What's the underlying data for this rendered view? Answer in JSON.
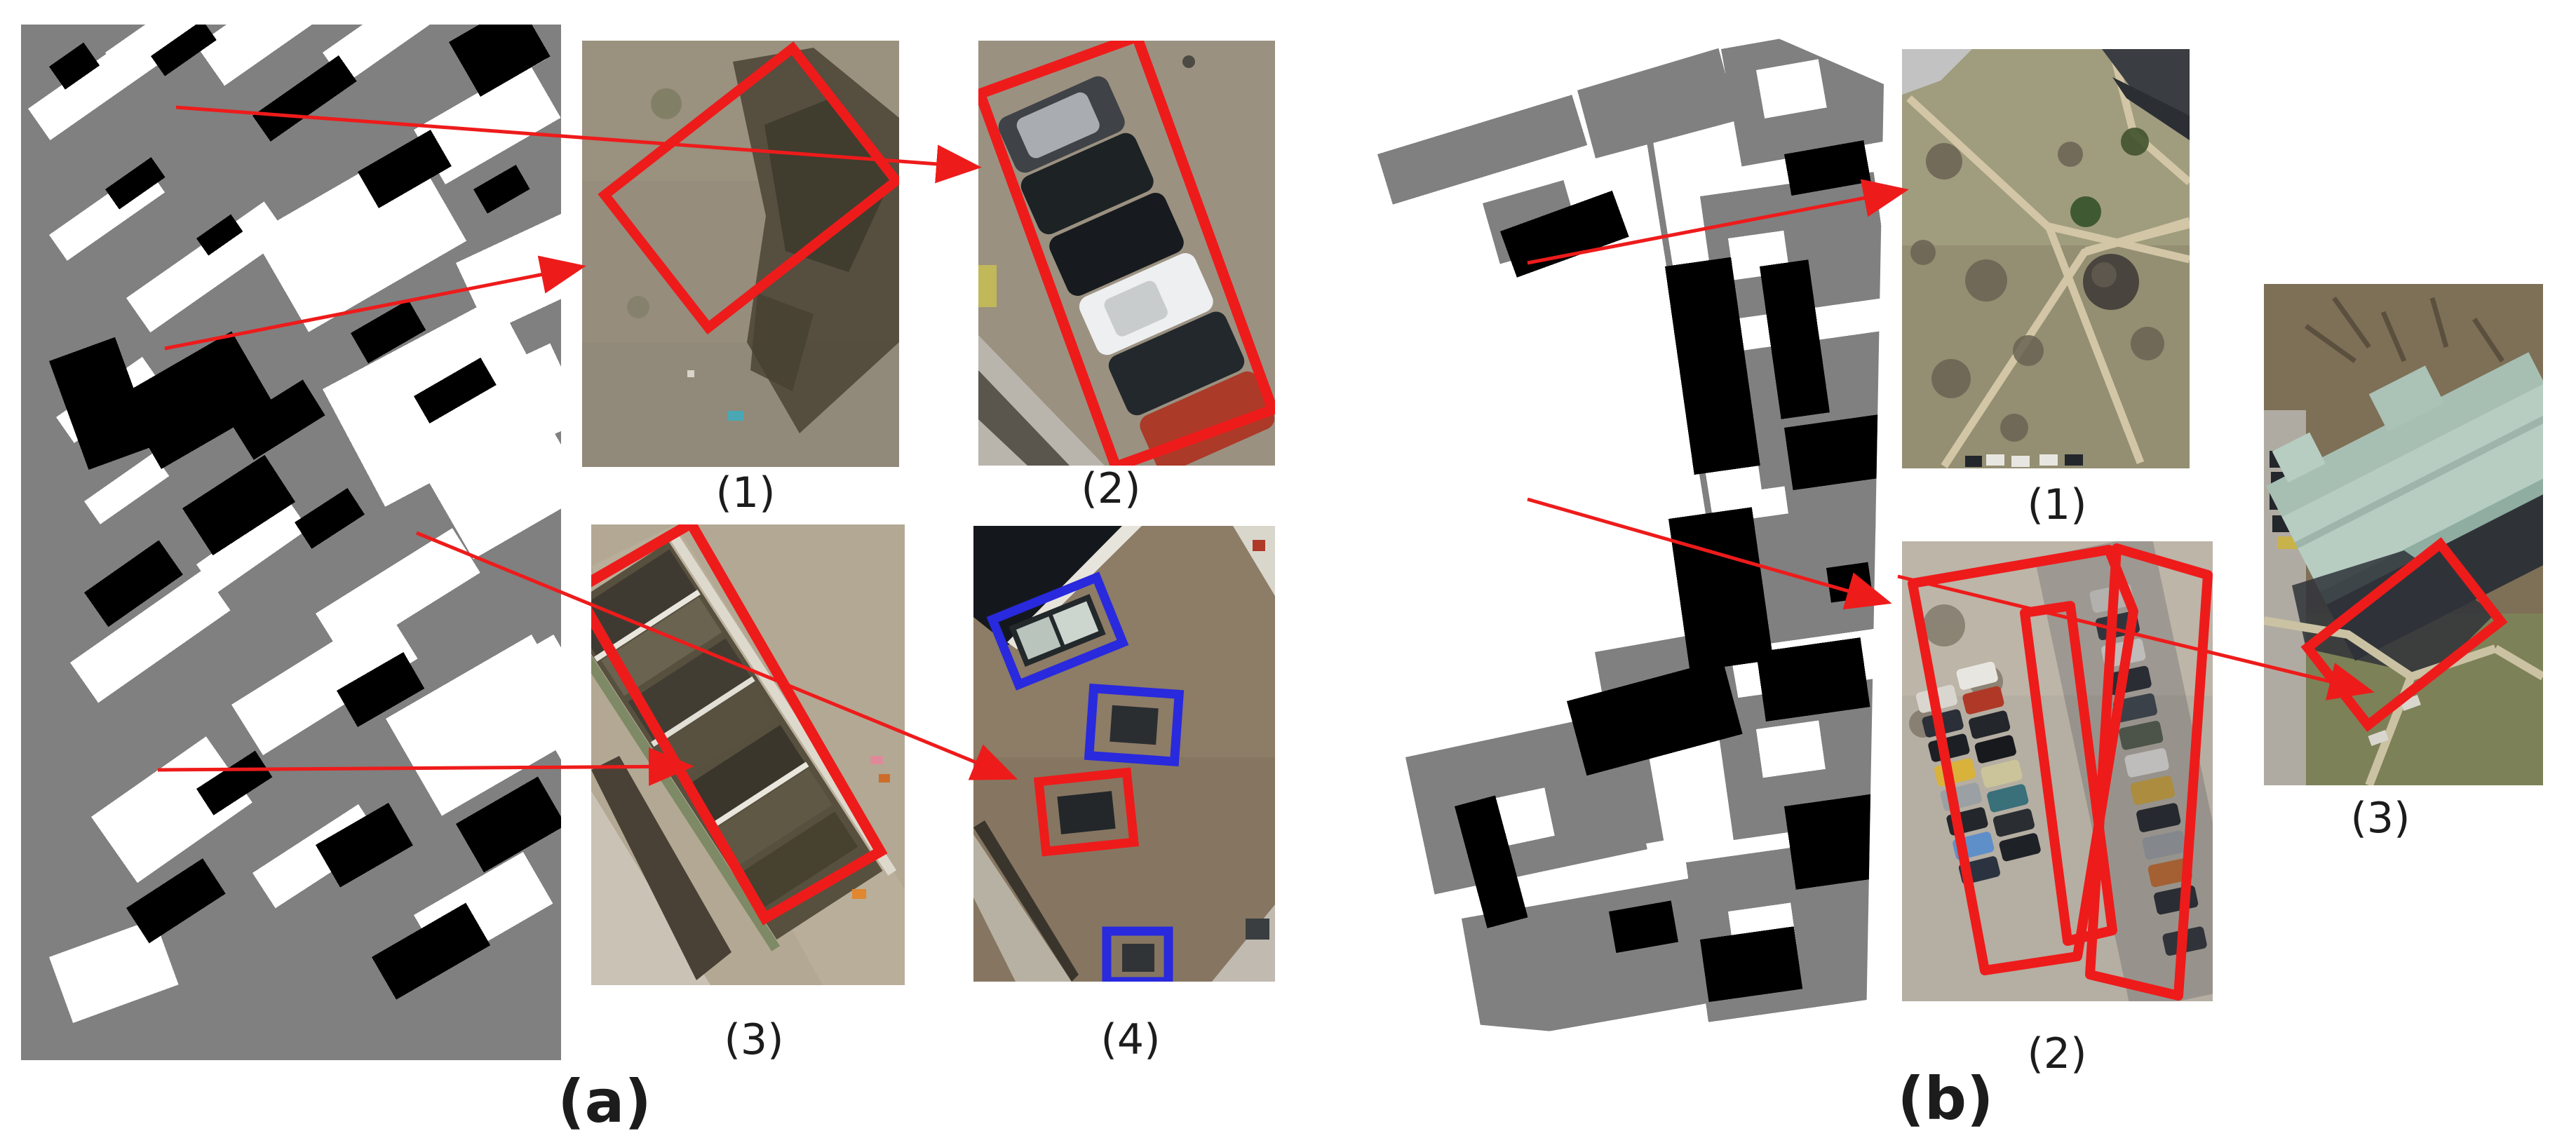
{
  "figure": {
    "type": "paper-figure",
    "description": "Semantic segmentation masks with zoomed aerial-image regions highlighted by red and blue boxes",
    "caption_a": "(a)",
    "caption_b": "(b)",
    "panel_a": {
      "mask": "segmentation-mask",
      "crop_labels": [
        "(1)",
        "(2)",
        "(3)",
        "(4)"
      ],
      "crop_contents": [
        "pavement with tree shadow, red rotated box",
        "column of parked cars, red rotated box",
        "row of backyards and roofs, red rotated box",
        "rooftop with skylights, three blue boxes and one red box"
      ]
    },
    "panel_b": {
      "mask": "segmentation-mask-rotated",
      "crop_labels": [
        "(1)",
        "(2)",
        "(3)"
      ],
      "crop_contents": [
        "park with crossing paths and pavilion",
        "parking lot rows of cars, red polygon outlines",
        "building with pale green roof, red rotated box"
      ]
    },
    "colors": {
      "annotation_red": "#ee1b1b",
      "annotation_blue": "#2929dd",
      "mask_gray": "#808080",
      "mask_black": "#000000",
      "mask_white": "#ffffff",
      "page_background": "#ffffff"
    }
  }
}
